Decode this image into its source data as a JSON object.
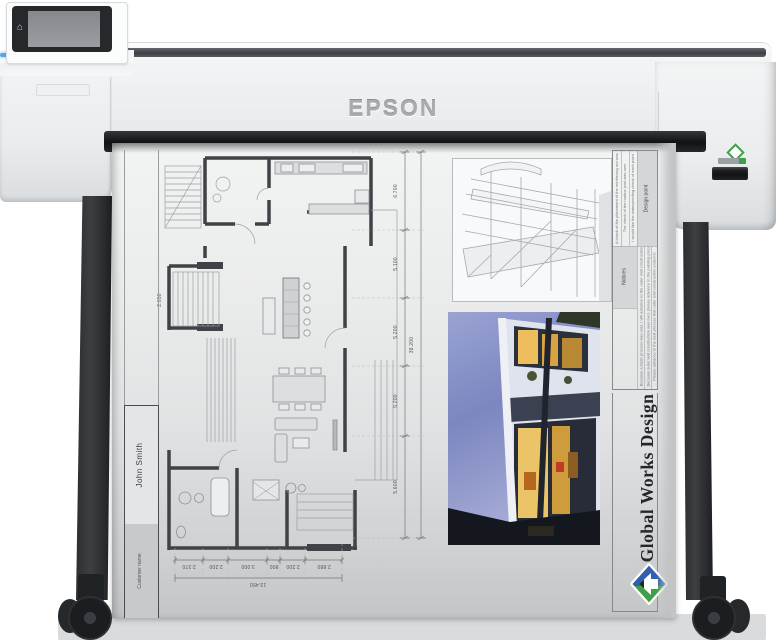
{
  "printer": {
    "brand": "EPSON",
    "control_panel": {
      "home_icon": "⌂"
    }
  },
  "sheet": {
    "title_block": {
      "value": "John Smith",
      "label": "Customer name"
    },
    "company": {
      "name": "Global Works Design"
    },
    "notes_table": {
      "design_point_header": "Design point",
      "notices_header": "Notices",
      "design_point_notes": [
        "A check of the placement of the reinforcing rod was over",
        "The check of the routine joint was over",
        "I would like the waterproofing check of each point"
      ],
      "notices_notes": [
        "Because a basic process was over, I will advance to the outer wall construction",
        "Because outer wall construction was over, please advance to the painting process",
        "Please advance to the next process that outer wall construction ended in"
      ]
    },
    "dimensions": {
      "vertical": [
        "6.700",
        "5.100",
        "5.200",
        "5.200",
        "5.600"
      ],
      "vertical_total": "38.200",
      "horizontal": [
        "2.370",
        "2.200",
        "3.000",
        "800",
        "2.200",
        "2.880"
      ],
      "horizontal_total": "13.450",
      "stair": "2.050"
    }
  }
}
